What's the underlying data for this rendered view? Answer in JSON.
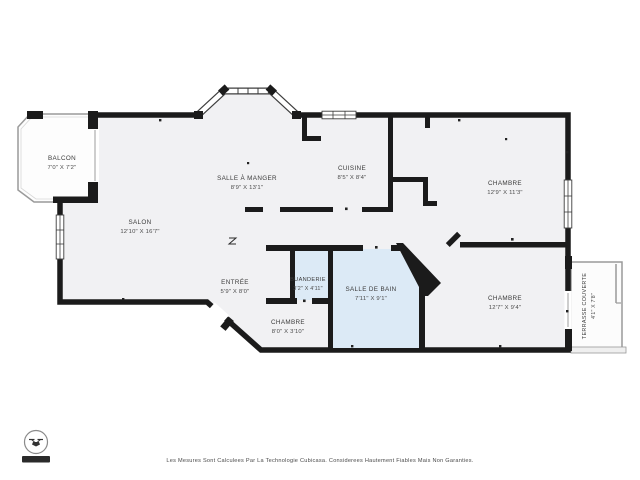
{
  "palette": {
    "wall": "#1b1b1b",
    "floor": "#f1f1f3",
    "wet_floor": "#dceaf6",
    "outdoor_stroke": "#9a9a9a",
    "label": "#3b3b3b",
    "badge": "#2a2a2a"
  },
  "rooms": [
    {
      "id": "balcon",
      "name": "BALCON",
      "dims": "7'0\" X 7'2\"",
      "type": "outdoor"
    },
    {
      "id": "salon",
      "name": "SALON",
      "dims": "12'10\" X 16'7\"",
      "type": "indoor"
    },
    {
      "id": "salle-a-manger",
      "name": "SALLE À MANGER",
      "dims": "8'9\" X 13'1\"",
      "type": "indoor"
    },
    {
      "id": "cuisine",
      "name": "CUISINE",
      "dims": "8'5\" X 8'4\"",
      "type": "indoor"
    },
    {
      "id": "chambre-1",
      "name": "CHAMBRE",
      "dims": "12'9\" X 11'3\"",
      "type": "indoor"
    },
    {
      "id": "entree",
      "name": "ENTRÉE",
      "dims": "5'9\" X 8'0\"",
      "type": "indoor"
    },
    {
      "id": "buanderie",
      "name": "BUANDERIE",
      "dims": "3'2\" X 4'11\"",
      "type": "wet"
    },
    {
      "id": "salle-de-bain",
      "name": "SALLE DE BAIN",
      "dims": "7'11\" X 9'1\"",
      "type": "wet"
    },
    {
      "id": "chambre-2",
      "name": "CHAMBRE",
      "dims": "8'0\" X 3'10\"",
      "type": "indoor"
    },
    {
      "id": "chambre-3",
      "name": "CHAMBRE",
      "dims": "12'7\" X 9'4\"",
      "type": "indoor"
    },
    {
      "id": "terrasse",
      "name": "TERRASSE COUVERTE",
      "dims": "4'1\" X 7'8\"",
      "type": "outdoor"
    }
  ],
  "footer": {
    "disclaimer": "Les Mesures Sont Calculees Par La Technologie Cubicasa. Considerees Hautement Fiables Mais Non Garanties."
  },
  "logo": {
    "icon": "drone-icon",
    "badge_text": ""
  }
}
